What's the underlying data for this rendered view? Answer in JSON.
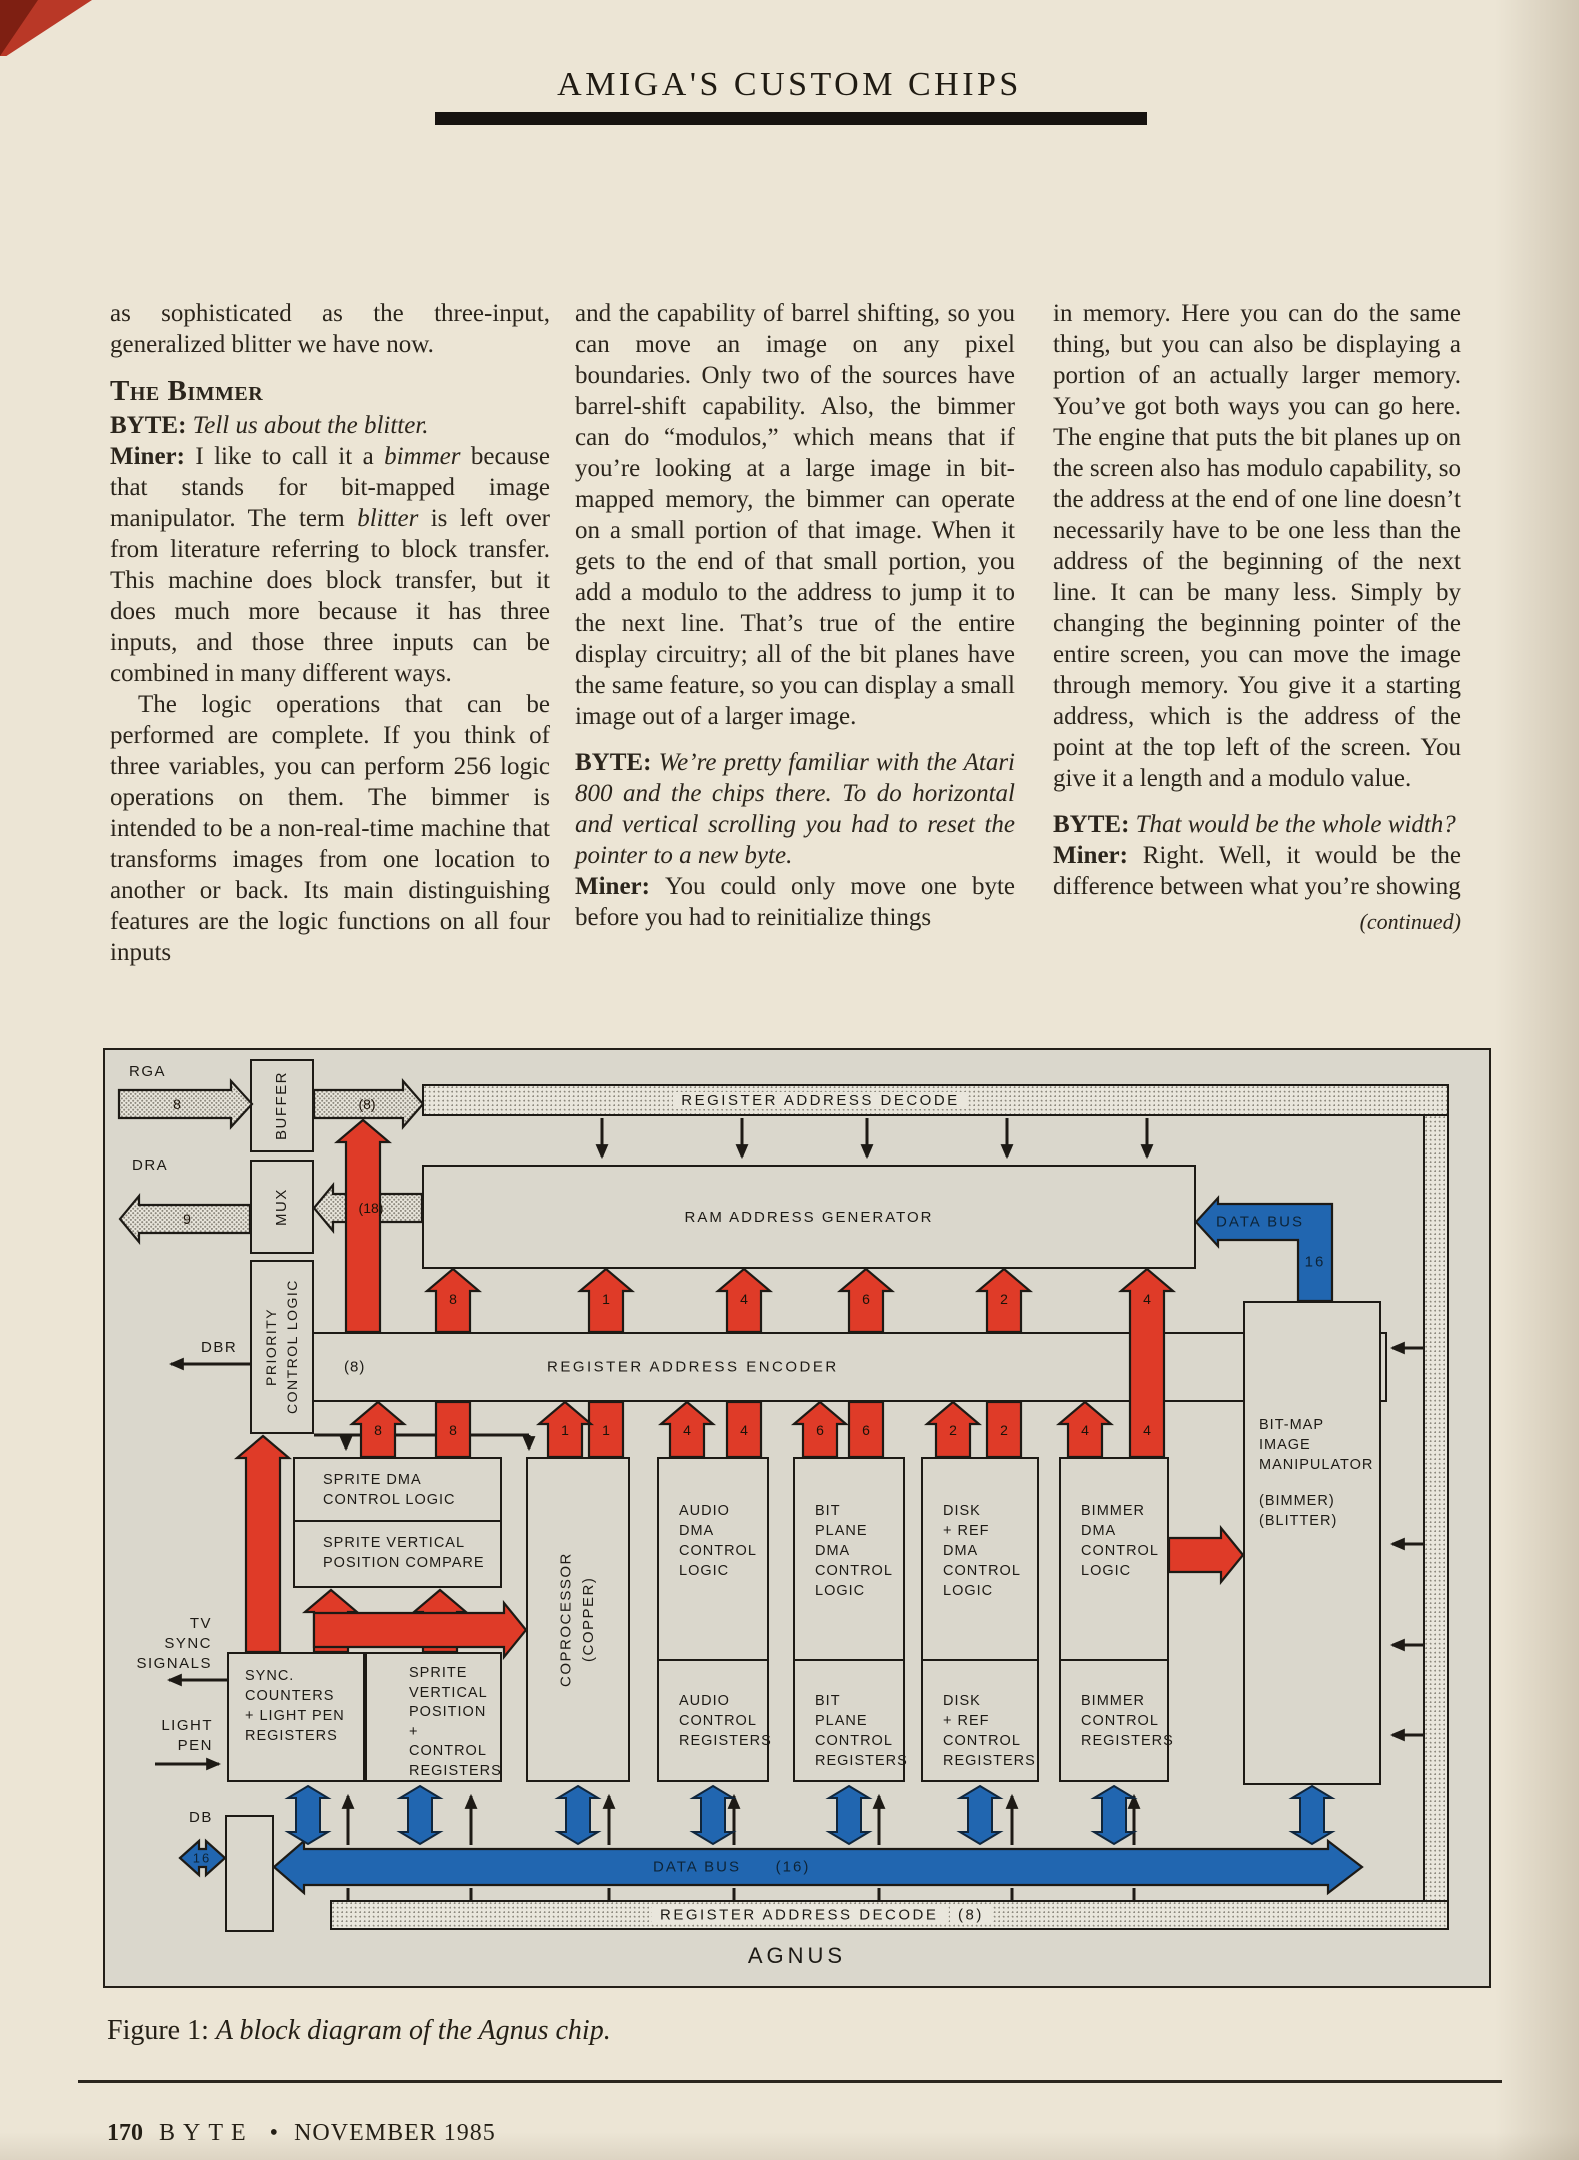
{
  "page": {
    "header_title": "AMIGA'S CUSTOM CHIPS",
    "caption_label": "Figure 1:",
    "caption_text": "A block diagram of the Agnus chip.",
    "footer_page": "170",
    "footer_magazine": "BYTE",
    "footer_sep": "•",
    "footer_issue": "NOVEMBER 1985"
  },
  "article": {
    "columns": [
      {
        "blocks": [
          {
            "type": "body",
            "runs": [
              {
                "t": "as sophisticated as the three-input, generalized blitter we have now."
              }
            ]
          },
          {
            "type": "heading",
            "runs": [
              {
                "t": "The Bimmer"
              }
            ]
          },
          {
            "type": "qa",
            "runs": [
              {
                "t": "BYTE: ",
                "b": true
              },
              {
                "t": "Tell us about the blitter.",
                "i": true
              }
            ]
          },
          {
            "type": "qa",
            "runs": [
              {
                "t": "Miner: ",
                "b": true
              },
              {
                "t": "I like to call it a "
              },
              {
                "t": "bimmer",
                "i": true
              },
              {
                "t": " because that stands for bit-mapped image manipulator. The term "
              },
              {
                "t": "blitter",
                "i": true
              },
              {
                "t": " is left over from literature referring to block transfer. This machine does block transfer, but it does much more because it has three inputs, and those three inputs can be combined in many different ways."
              }
            ]
          },
          {
            "type": "body-indent",
            "runs": [
              {
                "t": "The logic operations that can be performed are complete. If you think of three variables, you can perform 256 logic operations on them. The bimmer is intended to be a non-real-time machine that transforms images from one location to another or back. Its main distinguishing features are the logic functions on all four inputs"
              }
            ]
          }
        ]
      },
      {
        "blocks": [
          {
            "type": "body",
            "runs": [
              {
                "t": "and the capability of barrel shifting, so you can move an image on any pixel boundaries. Only two of the sources have barrel-shift capability. Also, the bimmer can do “modulos,” which means that if you’re looking at a large image in bit-mapped memory, the bimmer can operate on a small portion of that image. When it gets to the end of that small portion, you add a modulo to the address to jump it to the next line. That’s true of the entire display circuitry; all of the bit planes have the same feature, so you can display a small image out of a larger image."
              }
            ]
          },
          {
            "type": "qa",
            "runs": [
              {
                "t": "BYTE: ",
                "b": true
              },
              {
                "t": "We’re pretty familiar with the Atari 800 and the chips there. To do horizontal and vertical scrolling you had to reset the pointer to a new byte.",
                "i": true
              }
            ]
          },
          {
            "type": "qa",
            "runs": [
              {
                "t": "Miner: ",
                "b": true
              },
              {
                "t": "You could only move one byte before you had to reinitialize things"
              }
            ]
          }
        ]
      },
      {
        "blocks": [
          {
            "type": "body",
            "runs": [
              {
                "t": "in memory. Here you can do the same thing, but you can also be displaying a portion of an actually larger memory. You’ve got both ways you can go here. The engine that puts the bit planes up on the screen also has modulo capability, so the address at the end of one line doesn’t necessarily have to be one less than the address of the beginning of the next line. It can be many less. Simply by changing the beginning pointer of the entire screen, you can move the image through memory. You give it a starting address, which is the address of the point at the top left of the screen. You give it a length and a modulo value."
              }
            ]
          },
          {
            "type": "qa",
            "runs": [
              {
                "t": "BYTE: ",
                "b": true
              },
              {
                "t": "That would be the whole width?",
                "i": true
              }
            ]
          },
          {
            "type": "qa",
            "runs": [
              {
                "t": "Miner: ",
                "b": true
              },
              {
                "t": "Right. Well, it would be the difference between what you’re showing"
              }
            ]
          },
          {
            "type": "continued",
            "runs": [
              {
                "t": "(continued)",
                "i": true
              }
            ]
          }
        ]
      }
    ]
  },
  "diagram": {
    "chip_name": "AGNUS",
    "channel_numbers": [
      "8",
      "1",
      "4",
      "6",
      "2",
      "4"
    ],
    "labels": {
      "rga": "RGA",
      "rga_width": "8",
      "dra": "DRA",
      "dra_width": "9",
      "dbr": "DBR",
      "bus8": "(8)",
      "bus18": "(18)",
      "buffer_top": "BUFFER",
      "mux": "MUX",
      "priority": "PRIORITY\nCONTROL LOGIC",
      "decode_top": "REGISTER ADDRESS DECODE",
      "ram_gen": "RAM ADDRESS GENERATOR",
      "encoder": "REGISTER ADDRESS ENCODER",
      "encoder_width": "(8)",
      "data_bus_top": "DATA BUS",
      "data_bus_top_width": "16",
      "sprite_dma": "SPRITE DMA\nCONTROL LOGIC",
      "sprite_compare": "SPRITE VERTICAL\nPOSITION COMPARE",
      "coprocessor": "COPROCESSOR\n(COPPER)",
      "audio_dma": "AUDIO\nDMA\nCONTROL\nLOGIC",
      "audio_regs": "AUDIO\nCONTROL\nREGISTERS",
      "bitplane_dma": "BIT\nPLANE\nDMA\nCONTROL\nLOGIC",
      "bitplane_regs": "BIT\nPLANE\nCONTROL\nREGISTERS",
      "disk_dma": "DISK\n+ REF\nDMA\nCONTROL\nLOGIC",
      "disk_regs": "DISK\n+ REF\nCONTROL\nREGISTERS",
      "bimmer_dma": "BIMMER\nDMA\nCONTROL\nLOGIC",
      "bimmer_regs": "BIMMER\nCONTROL\nREGISTERS",
      "bitmap": "BIT-MAP\nIMAGE\nMANIPULATOR",
      "bitmap_alias": "(BIMMER)\n(BLITTER)",
      "sync_regs": "SYNC.\nCOUNTERS\n+ LIGHT PEN\nREGISTERS",
      "sprite_regs": "SPRITE\nVERTICAL\nPOSITION\n+ CONTROL\nREGISTERS",
      "tv_sync": "TV\nSYNC\nSIGNALS",
      "light_pen": "LIGHT\nPEN",
      "db": "DB",
      "db_width": "16",
      "data_bus_bottom": "DATA BUS",
      "data_bus_bottom_width": "(16)",
      "decode_bottom": "REGISTER ADDRESS DECODE",
      "decode_bottom_width": "(8)"
    }
  },
  "colors": {
    "accent_red": "#df3b28",
    "bus_blue": "#2166b0",
    "page_bg": "#ece5d5",
    "diagram_bg": "#dad7cc",
    "ink": "#1d1a15"
  }
}
